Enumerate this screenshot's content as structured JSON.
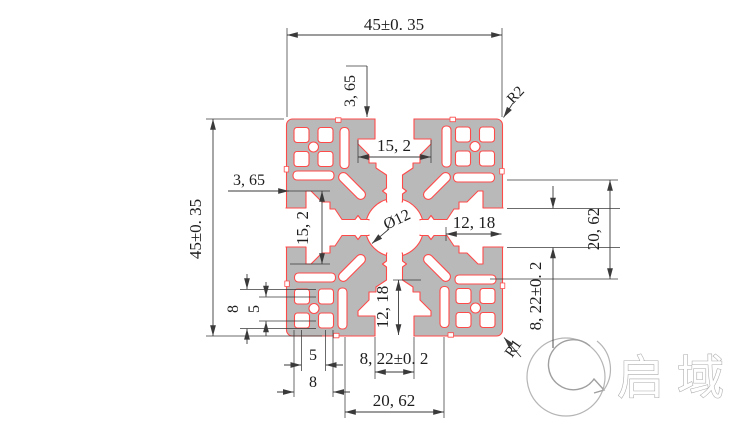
{
  "drawing": {
    "dimensions": {
      "overall_width_top": "45±0. 35",
      "overall_height_left": "45±0. 35",
      "lip_depth_top": "3, 65",
      "lip_depth_left": "3, 65",
      "cavity_width_top": "15, 2",
      "cavity_width_left": "15, 2",
      "center_bore": "Ø12",
      "slot_depth_right": "12, 18",
      "slot_depth_bottom": "12, 18",
      "slot_span_right": "20, 62",
      "slot_span_bottom": "20, 62",
      "slot_opening_right": "8, 22±0. 2",
      "slot_opening_bottom": "8, 22±0. 2",
      "corner_hole_outer_vertical": "8",
      "corner_hole_pitch_vertical": "5",
      "corner_hole_pitch_bottom": "5",
      "corner_hole_outer_bottom": "8",
      "outer_corner_radius": "R2",
      "inner_corner_radius": "R1"
    },
    "watermark": {
      "brand_text": "启域"
    },
    "colors": {
      "profile_fill": "#b9b9b9",
      "profile_outline": "#ff4a4a",
      "dimension_color": "#3a3a3a",
      "watermark_color": "#a8a8a8",
      "background": "#ffffff"
    }
  }
}
